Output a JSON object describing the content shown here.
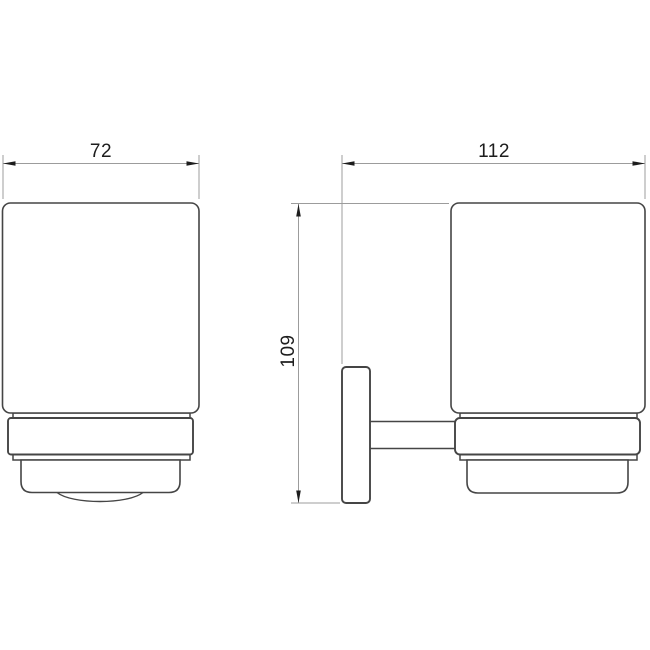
{
  "drawing": {
    "labels": {
      "front_width": "72",
      "side_width": "112",
      "side_height": "109"
    },
    "colors": {
      "background": "#ffffff",
      "object_outline": "#454545",
      "dimension_line": "#9c9c9c",
      "dimension_text": "#1d1d1d"
    }
  }
}
